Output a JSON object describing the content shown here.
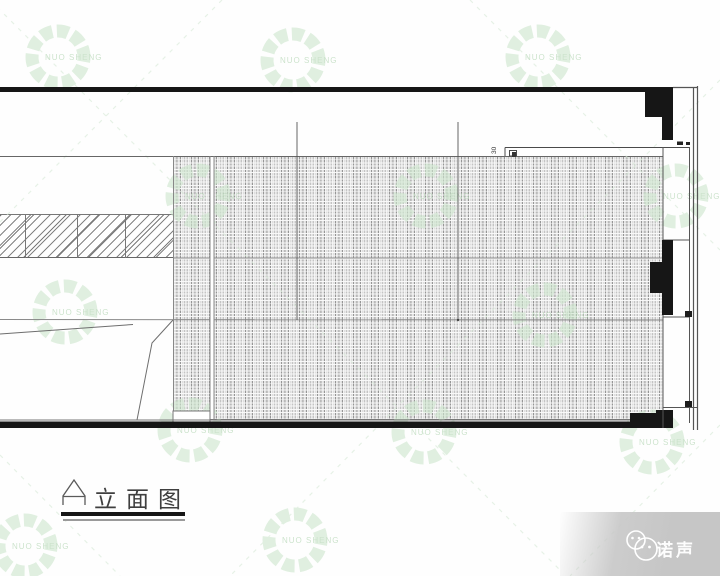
{
  "theme": {
    "watermark_green": "#cfe7cf",
    "watermark_text_green": "#aed3ae",
    "line_dark": "#161616",
    "footer_gray": "#c6c6c6"
  },
  "drawing": {
    "caption": "立面图",
    "dimension_label": "30"
  },
  "watermark": {
    "text": "NUO SHENG"
  },
  "footer": {
    "brand": "诺声"
  }
}
